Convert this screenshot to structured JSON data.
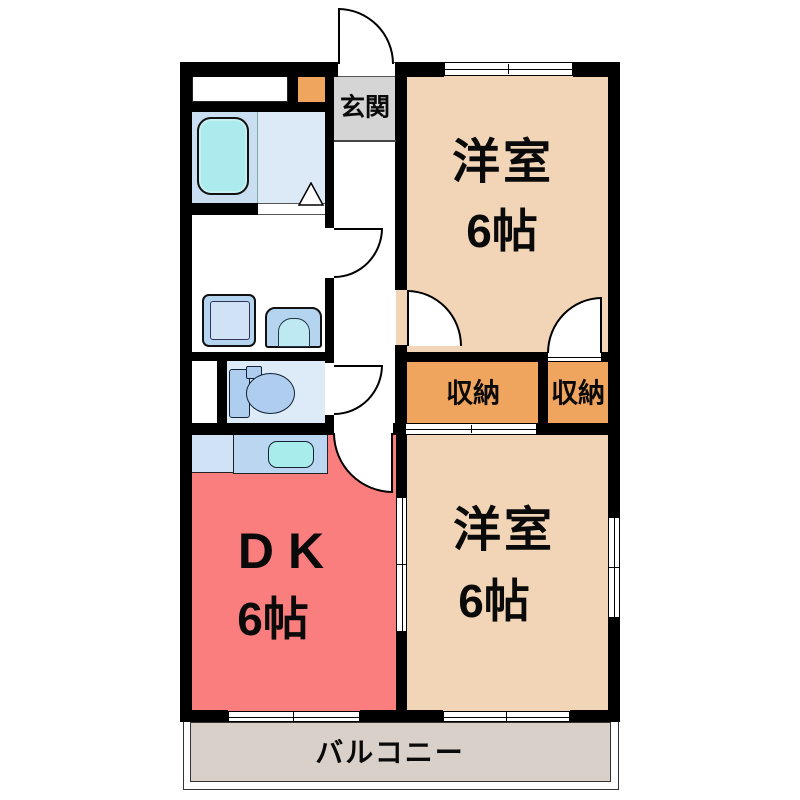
{
  "floorplan": {
    "type": "apartment-floor-plan",
    "rooms": {
      "genkan": {
        "label": "玄関"
      },
      "western_top": {
        "name": "洋室",
        "size": "6帖"
      },
      "western_bottom": {
        "name": "洋室",
        "size": "6帖"
      },
      "dk": {
        "name": "DK",
        "size": "6帖"
      },
      "storage_wide": {
        "label": "収納"
      },
      "storage_narrow": {
        "label": "収納"
      },
      "balcony": {
        "label": "バルコニー"
      }
    },
    "fixtures": [
      "bathtub",
      "washing-machine",
      "washbasin",
      "toilet",
      "kitchen-counter",
      "kitchen-sink",
      "shoe-cabinet",
      "closet"
    ],
    "colors": {
      "wall": "#000000",
      "western_room": "#F2D5B6",
      "dk": "#FB7E7E",
      "storage": "#F0A55E",
      "shoe_cabinet": "#F0A55E",
      "genkan": "#D5D5D5",
      "balcony": "#D9D1C9",
      "bath_floor": "#C9DEF1",
      "bath_floor_light": "#DCEAF8",
      "toilet_floor": "#DDEAF8",
      "bathtub": "#ABEBEE",
      "fixture_blue": "#B5D4F0",
      "fixture_blue_light": "#D0E3F6",
      "sink_cyan": "#A9ECEC"
    }
  }
}
